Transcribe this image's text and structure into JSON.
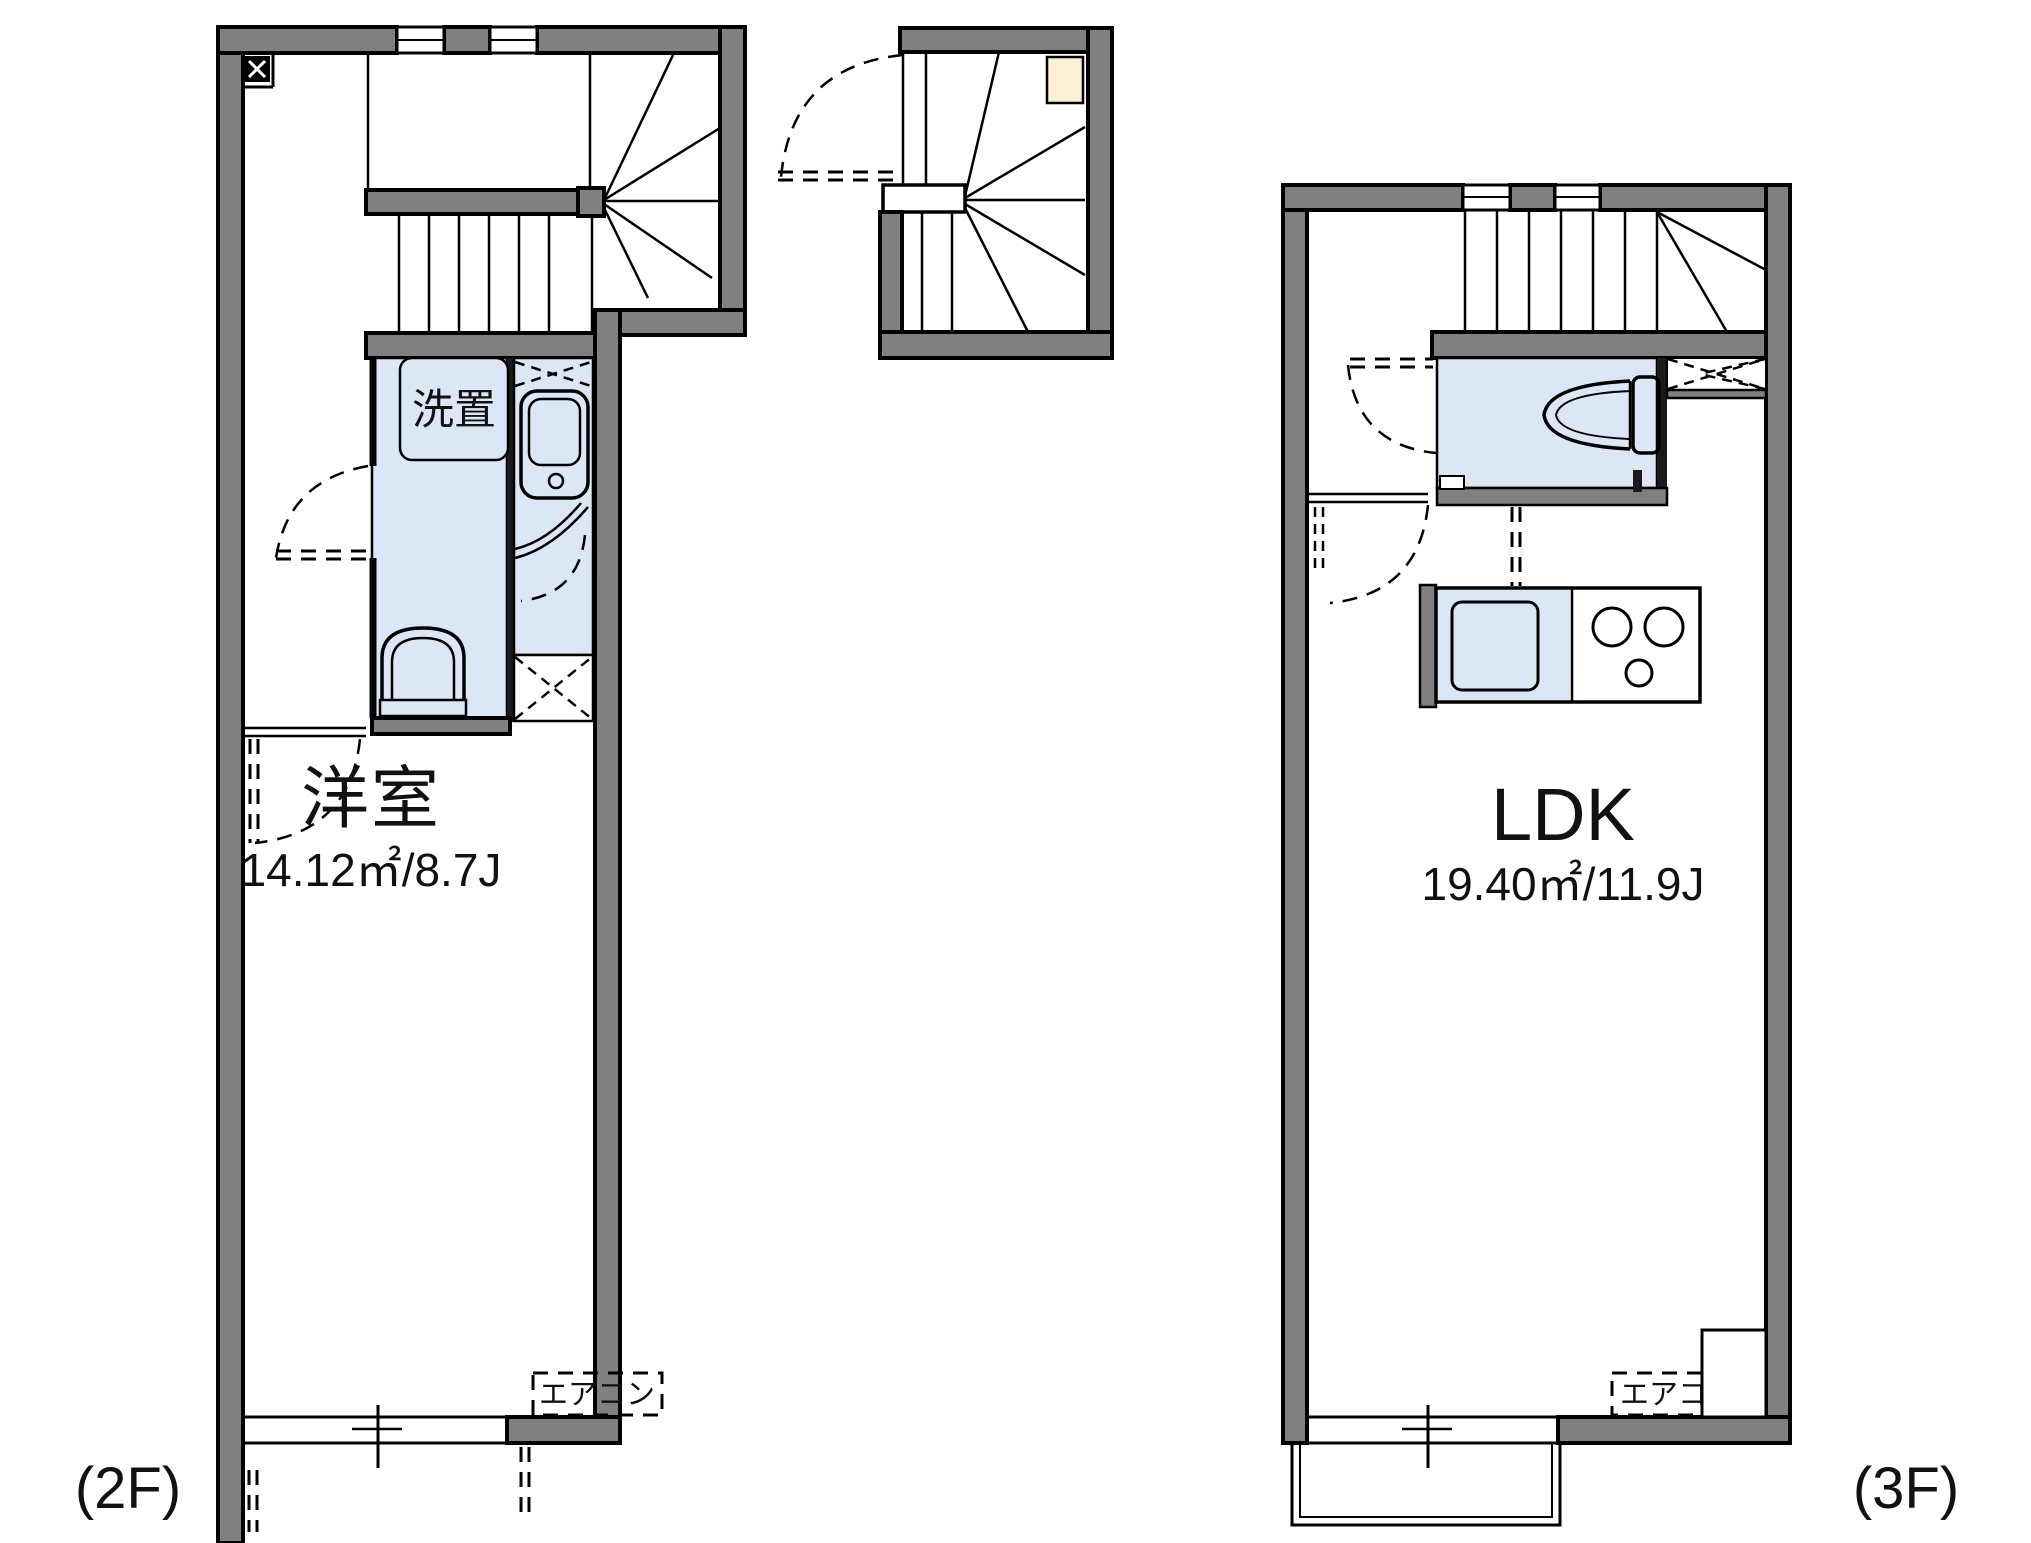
{
  "colors": {
    "wall": "#808080",
    "room_fill": "#dce7f6",
    "meter_box": "#fbf0d6",
    "line": "#000000",
    "background": "#ffffff"
  },
  "floor_2f": {
    "tag": "(2F)",
    "room": {
      "name": "洋室",
      "area": "14.12㎡/8.7J"
    },
    "laundry_label": "洗置",
    "aircon_label": "エアコン"
  },
  "floor_3f": {
    "tag": "(3F)",
    "room": {
      "name": "LDK",
      "area": "19.40㎡/11.9J"
    },
    "aircon_label": "エアコン"
  }
}
